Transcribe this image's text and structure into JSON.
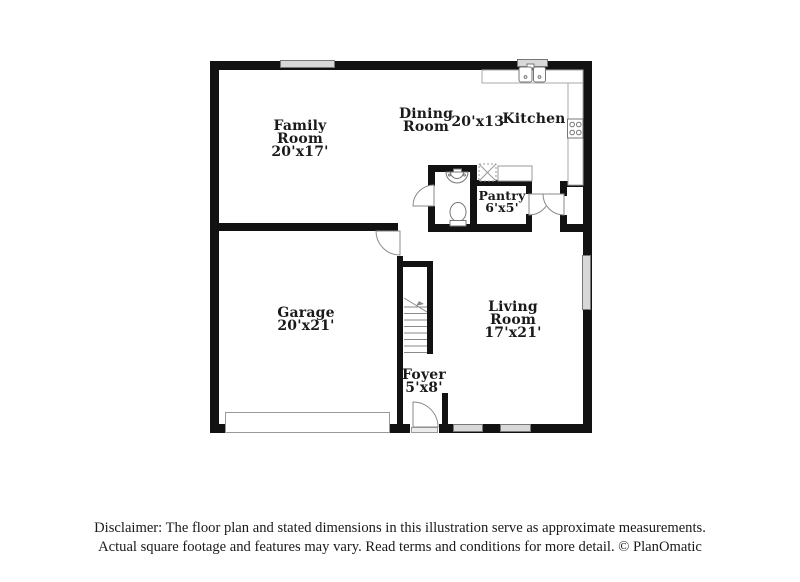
{
  "plan": {
    "rooms": {
      "family": {
        "name": "Family Room",
        "dims": "20'x17'"
      },
      "dining": {
        "name": "Dining Room",
        "dims": "20'x13'"
      },
      "kitchen": {
        "name": "Kitchen"
      },
      "pantry": {
        "name": "Pantry",
        "dims": "6'x5'"
      },
      "garage": {
        "name": "Garage",
        "dims": "20'x21'"
      },
      "living": {
        "name": "Living Room",
        "dims": "17'x21'"
      },
      "foyer": {
        "name": "Foyer",
        "dims": "5'x8'"
      }
    },
    "fixtures": [
      "kitchen-sink-icon",
      "stove-icon",
      "counter-icon",
      "appliance-icon",
      "pedestal-sink-icon",
      "toilet-icon",
      "staircase-icon",
      "garage-door-icon",
      "entry-door-icon",
      "door-swing-icon",
      "window-icon"
    ],
    "colors": {
      "wall": "#121212",
      "window_fill": "#d8d8d8",
      "fixture_line": "#8a8a8a",
      "text": "#1a1a1a"
    }
  },
  "disclaimer": {
    "line1": "Disclaimer: The floor plan and stated dimensions in this illustration serve as approximate measurements.",
    "line2": "Actual square footage and features may vary. Read terms and conditions for more detail. © PlanOmatic"
  }
}
